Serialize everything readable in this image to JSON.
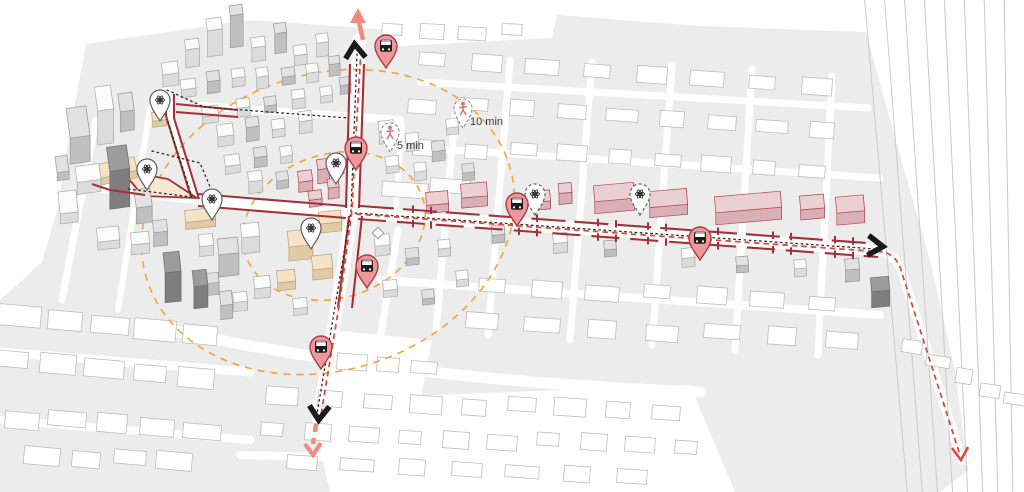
{
  "map": {
    "description": "Axonometric city map with transit corridor, bus stops, landmarks and walking radii",
    "walk_time_labels": {
      "inner": "5 min",
      "outer": "10 min"
    },
    "colors": {
      "route_red": "#A63038",
      "route_dashed_red": "#E2483F",
      "route_salmon": "#F28B7D",
      "walk_circle_orange": "#F0A93D",
      "arrow_black": "#1a1a1a",
      "pin_pink": "#F0979B",
      "pin_rim_red": "#A84048",
      "building_pink_top": "#EBD0D3",
      "building_tan_top": "#F4E3C6",
      "ground_gray": "#ECECEC",
      "walker_red": "#D4767A"
    },
    "markers": {
      "bus_stops": [
        {
          "x": 386,
          "y": 68
        },
        {
          "x": 356,
          "y": 170
        },
        {
          "x": 367,
          "y": 288
        },
        {
          "x": 321,
          "y": 369
        },
        {
          "x": 517,
          "y": 226
        },
        {
          "x": 700,
          "y": 260
        }
      ],
      "landmarks": [
        {
          "x": 160,
          "y": 121
        },
        {
          "x": 147,
          "y": 190
        },
        {
          "x": 212,
          "y": 220
        },
        {
          "x": 336,
          "y": 184
        },
        {
          "x": 311,
          "y": 249
        },
        {
          "x": 535,
          "y": 215,
          "dashed": true
        },
        {
          "x": 640,
          "y": 215,
          "dashed": true
        }
      ],
      "walk_pins": [
        {
          "x": 390,
          "y": 152,
          "label": "5 min"
        },
        {
          "x": 463,
          "y": 128,
          "label": "10 min"
        }
      ]
    },
    "icons": {
      "bus_stop": "bus-front-icon",
      "landmark": "flower-asterisk-icon",
      "walk": "pedestrian-icon",
      "north_arrow": "chevron-up",
      "south_arrow": "chevron-down",
      "east_arrow": "chevron-right"
    }
  }
}
